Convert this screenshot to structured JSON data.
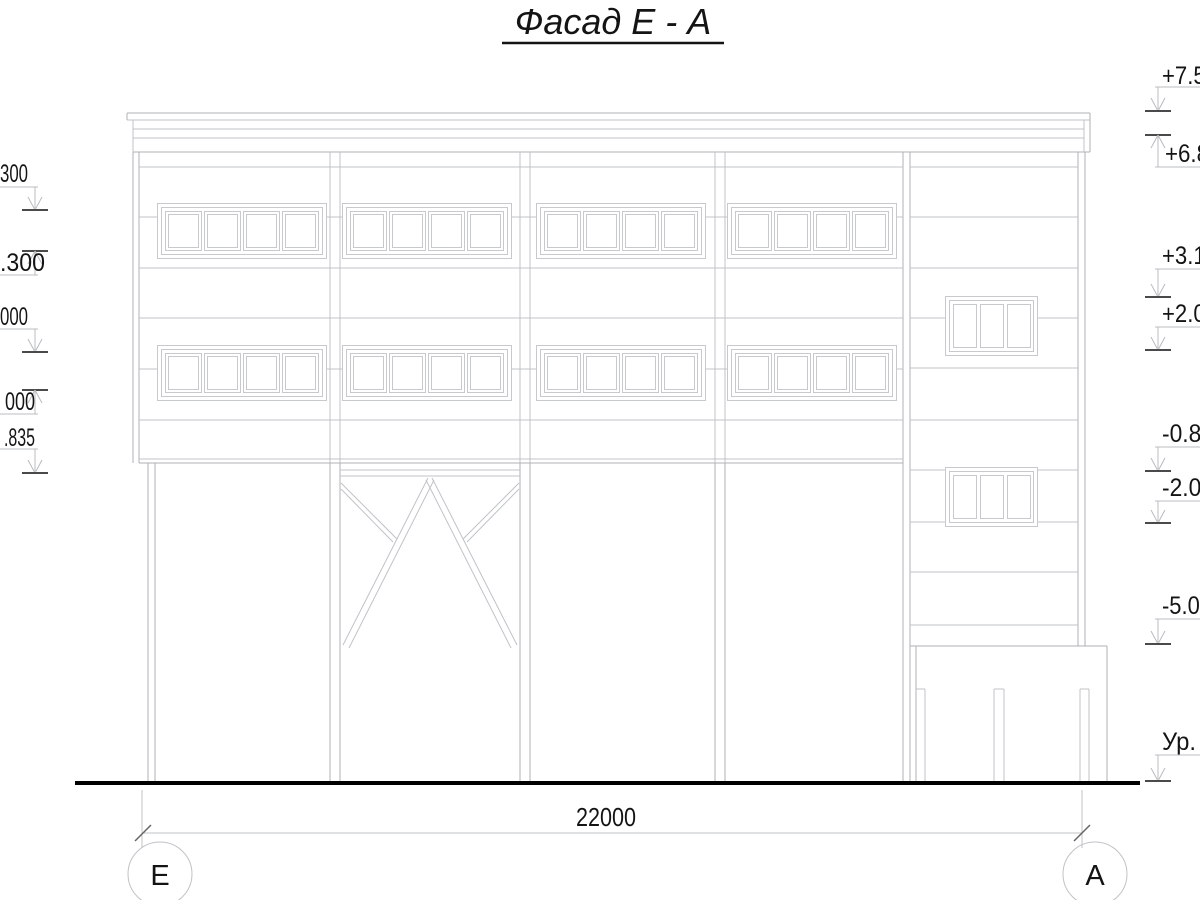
{
  "title": "Фасад Е - А",
  "levels": {
    "left": [
      {
        "label": "300"
      },
      {
        "label": ".300"
      },
      {
        "label": "000"
      },
      {
        "label": "000"
      },
      {
        "label": ".835"
      }
    ],
    "right": [
      {
        "label": "+7.50"
      },
      {
        "label": "+6.8"
      },
      {
        "label": "+3.19"
      },
      {
        "label": "+2.00"
      },
      {
        "label": "-0.83"
      },
      {
        "label": "-2.02"
      },
      {
        "label": "-5.00"
      },
      {
        "label": "Ур."
      }
    ]
  },
  "dimension": {
    "value": "22000"
  },
  "axes": {
    "left": "Е",
    "right": "А"
  },
  "colors": {
    "line": "#bfc3c7",
    "text": "#141414",
    "tick": "#4a4a4a",
    "ground": "#000000"
  }
}
